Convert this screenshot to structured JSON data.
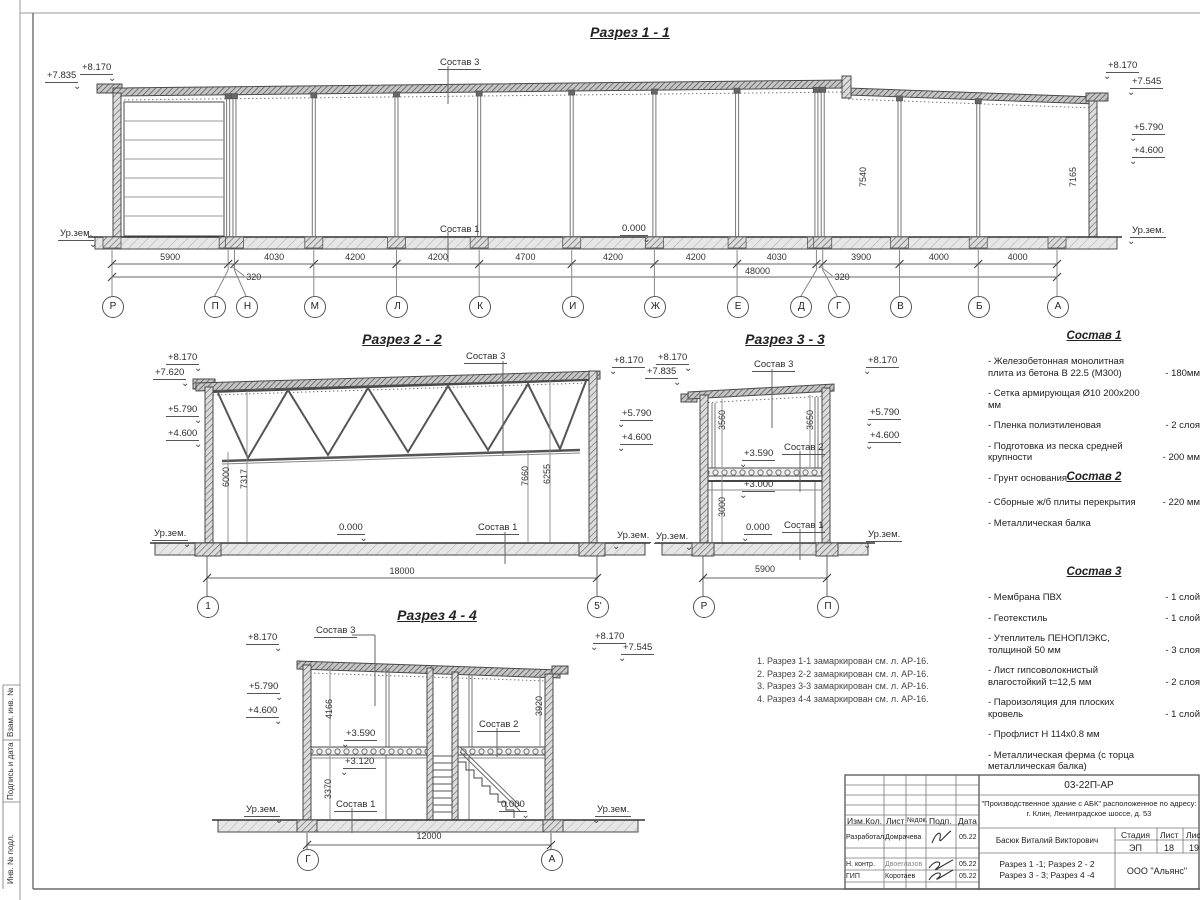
{
  "common": {
    "ursem": "Ур.зем.",
    "zero": "0.000",
    "s1": "Состав 1",
    "s2": "Состав 2",
    "s3": "Состав 3",
    "e8170": "+8.170",
    "e7835": "+7.835",
    "e7620": "+7.620",
    "e7545": "+7.545",
    "e5790": "+5.790",
    "e4600": "+4.600",
    "e3590": "+3.590",
    "e3120": "+3.120",
    "e3000": "+3.000"
  },
  "s11": {
    "title": "Разрез 1 - 1",
    "total": "48000",
    "h_left": "7540",
    "h_right": "7165",
    "dims": [
      "5900",
      "320",
      "4030",
      "4200",
      "4200",
      "4700",
      "4200",
      "4200",
      "4030",
      "320",
      "3900",
      "4000",
      "4000"
    ],
    "axes": [
      "Р",
      "П",
      "Н",
      "М",
      "Л",
      "К",
      "И",
      "Ж",
      "Е",
      "Д",
      "Г",
      "В",
      "Б",
      "А"
    ]
  },
  "s22": {
    "title": "Разрез 2 - 2",
    "width": "18000",
    "axes": [
      "1",
      "5'"
    ],
    "h1": "6000",
    "h2": "7317",
    "h3": "7660",
    "h4": "6255"
  },
  "s33": {
    "title": "Разрез 3 - 3",
    "width": "5900",
    "axes": [
      "Р",
      "П"
    ],
    "h1": "3560",
    "h2": "3650",
    "h3": "3000"
  },
  "s44": {
    "title": "Разрез 4 - 4",
    "width": "12000",
    "axes": [
      "Г",
      "А"
    ],
    "h1": "4166",
    "h2": "3920",
    "h3": "3370"
  },
  "notes": [
    "1. Разрез 1-1 замаркирован см. л. АР-16.",
    "2. Разрез 2-2 замаркирован см. л. АР-16.",
    "3. Разрез 3-3 замаркирован см. л. АР-16.",
    "4. Разрез 4-4 замаркирован см. л. АР-16."
  ],
  "sostav": [
    {
      "title": "Состав 1",
      "items": [
        {
          "n": "- Железобетонная  монолитная плита из бетона В 22.5 (М300)",
          "q": "- 180мм"
        },
        {
          "n": "- Сетка армирующая Ø10 200х200 мм",
          "q": ""
        },
        {
          "n": "- Пленка полиэтиленовая",
          "q": "- 2 слоя"
        },
        {
          "n": "- Подготовка из песка средней крупности",
          "q": "- 200 мм"
        },
        {
          "n": "- Грунт основания",
          "q": ""
        }
      ]
    },
    {
      "title": "Состав 2",
      "items": [
        {
          "n": "- Сборные ж/б плиты перекрытия",
          "q": "- 220 мм"
        },
        {
          "n": "- Металлическая балка",
          "q": ""
        }
      ]
    },
    {
      "title": "Состав 3",
      "items": [
        {
          "n": "- Мембрана ПВХ",
          "q": "- 1 слой"
        },
        {
          "n": "- Геотекстиль",
          "q": "- 1 слой"
        },
        {
          "n": "- Утеплитель ПЕНОПЛЭКС, толщиной 50 мм",
          "q": "- 3 слоя"
        },
        {
          "n": "- Лист гипсоволокнистый влагостойкий t=12,5 мм",
          "q": "- 2 слоя"
        },
        {
          "n": "- Пароизоляция для плоских кровель",
          "q": "- 1 слой"
        },
        {
          "n": "- Профлист Н 114х0.8 мм",
          "q": ""
        },
        {
          "n": "- Металлическая ферма (с торца металлическая балка)",
          "q": ""
        }
      ]
    }
  ],
  "frame_labels": [
    "Взам. инв. №",
    "Подпись и дата",
    "Инв. № подл."
  ],
  "stamp": {
    "code": "03-22П-АР",
    "project1": "\"Производственное здание с АБК\" расположенное по адресу:",
    "project2": "г. Клин, Ленинградское шоссе, д. 53",
    "h_izm": "Изм.Кол.",
    "h_list": "Лист",
    "h_doc": "№док.",
    "h_podp": "Подп.",
    "h_data": "Дата",
    "rows": [
      {
        "role": "Разработал",
        "name": "Домрачева",
        "date": "05.22"
      },
      {
        "role": "Н. контр.",
        "name": "Двоеглазов",
        "date": "05.22"
      },
      {
        "role": "ГИП",
        "name": "Коротаев",
        "date": "05.22"
      }
    ],
    "author": "Басюк Виталий Викторович",
    "stage_h": "Стадия",
    "list_h": "Лист",
    "listov_h": "Листов",
    "stage": "ЭП",
    "list": "18",
    "listov": "19",
    "title1": "Разрез 1 -1;  Разрез 2 - 2",
    "title2": "Разрез 3 - 3;  Разрез 4 -4",
    "company": "ООО \"Альянс\""
  }
}
